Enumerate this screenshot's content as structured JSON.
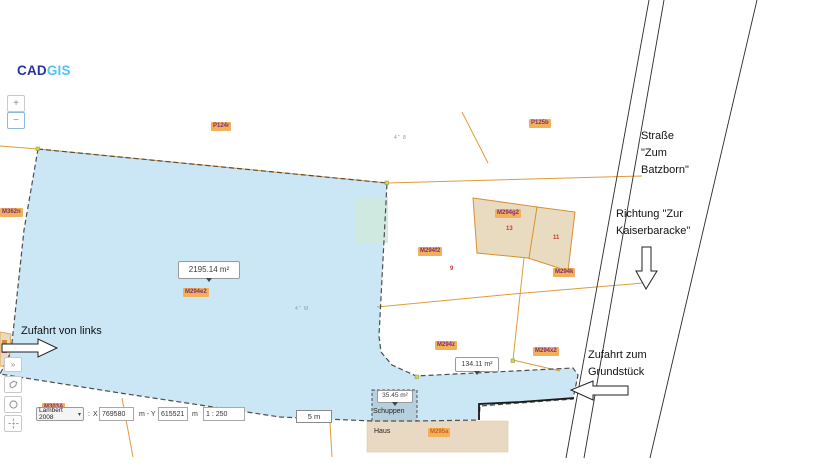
{
  "brand": {
    "cad": "CAD",
    "gis": "GIS"
  },
  "zoom_controls": {
    "zoom_in": "+",
    "zoom_out": "−"
  },
  "side_tools": {
    "expand": "»"
  },
  "coordinate_bar": {
    "crs": "Lambert 2008",
    "colon": ":",
    "x_label": "X",
    "x_value": "769580",
    "between_label": "m - Y",
    "y_value": "615521",
    "unit_label": "m",
    "scale_value": "1 : 250"
  },
  "scale_bar": {
    "label": "5 m"
  },
  "annotations": {
    "strasse": {
      "lines": [
        "Straße",
        "\"Zum",
        "Batzborn\""
      ]
    },
    "richtung": {
      "lines": [
        "Richtung \"Zur",
        "Kaiserbaracke\""
      ]
    },
    "zufahrt_links": {
      "text": "Zufahrt von links"
    },
    "zufahrt_grundstueck": {
      "lines": [
        "Zufahrt zum",
        "Grundstück"
      ]
    }
  },
  "area_labels": [
    {
      "text": "2195.14 m²"
    },
    {
      "text": "134.11 m²"
    },
    {
      "text": "35.45 m²"
    }
  ],
  "parcel_labels": [
    {
      "text": "P124r"
    },
    {
      "text": "P125b"
    },
    {
      "text": "M362n"
    },
    {
      "text": "M294g2"
    },
    {
      "text": "M294f2"
    },
    {
      "text": "M294k"
    },
    {
      "text": "M294z"
    },
    {
      "text": "M294x2"
    },
    {
      "text": "M294e2"
    },
    {
      "text": "M295a"
    },
    {
      "text": "M303A"
    }
  ],
  "building_labels": {
    "schuppen": "Schuppen",
    "haus": "Haus"
  },
  "house_numbers": [
    "13",
    "11",
    "9"
  ],
  "tiny_marks": [
    "4\" 8",
    "4\" M"
  ],
  "colors": {
    "brand_cad": "#27349b",
    "brand_gis": "#55c3f0",
    "parcel_fill": "#cbe6f5",
    "parcel_outline": "#4d4d4d",
    "cadastral_line": "#dd9c3a",
    "building_fill": "#e9dbc0",
    "schuppen_fill": "#b7d0dd",
    "haus_fill": "#ead9c2",
    "chip_bg": "#f2b05a",
    "chip_text": "#7c2d74",
    "red_number": "#c23a2e",
    "road_line": "#2a2a2a"
  }
}
